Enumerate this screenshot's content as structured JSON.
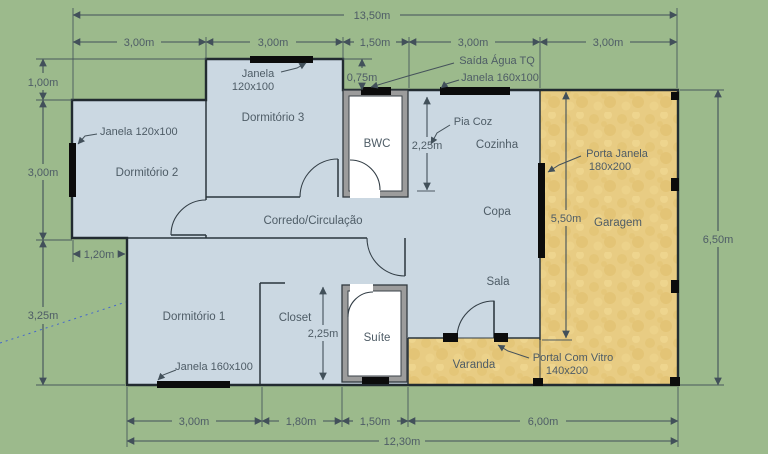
{
  "plan": {
    "rooms": {
      "dormitorio2": "Dormitório 2",
      "dormitorio3": "Dormitório 3",
      "dormitorio1": "Dormitório 1",
      "corredor": "Corredo/Circulação",
      "bwc": "BWC",
      "closet": "Closet",
      "suite": "Suíte",
      "cozinha": "Cozinha",
      "copa": "Copa",
      "sala": "Sala",
      "garagem": "Garagem",
      "varanda": "Varanda"
    },
    "dims": {
      "total_w": "13,50m",
      "top": [
        "3,00m",
        "3,00m",
        "1,50m",
        "3,00m",
        "3,00m"
      ],
      "left_top": "1,00m",
      "left_mid": "3,00m",
      "left_bot": "3,25m",
      "step": "1,20m",
      "bwc_top": "0,75m",
      "cozinha_d": "2,25m",
      "closet_d": "2,25m",
      "garagem_d": "5,50m",
      "total_h": "6,50m",
      "bottom": [
        "3,00m",
        "1,80m",
        "1,50m",
        "6,00m"
      ],
      "bottom_total": "12,30m"
    },
    "ann": {
      "janela_d2": "Janela 120x100",
      "janela_d3a": "Janela",
      "janela_d3b": "120x100",
      "saida": "Saída Água TQ",
      "janela_coz": "Janela 160x100",
      "pia": "Pia Coz",
      "porta_a": "Porta Janela",
      "porta_b": "180x200",
      "portal_a": "Portal Com Vitro",
      "portal_b": "140x200",
      "janela_d1": "Janela 160x100"
    },
    "colors": {
      "grass": "#9cba8c",
      "floor": "#cbd8e2",
      "sand": "#e8cc83",
      "wall": "#222b31",
      "dim_line": "#42505a",
      "text": "#4e5c66",
      "guide": "#4466cc"
    }
  }
}
